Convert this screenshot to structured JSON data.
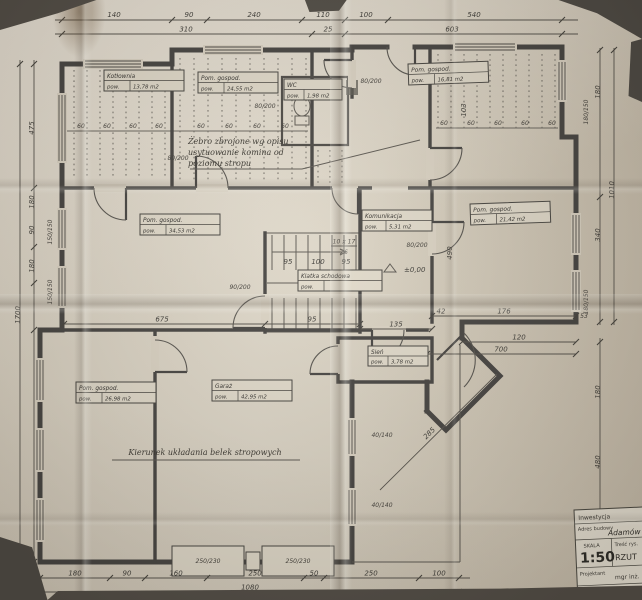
{
  "scene": {
    "background": "#55504a",
    "paper": "#dcd4c4",
    "ink": "#454340"
  },
  "rooms": [
    {
      "name": "Kotłownia",
      "pow": "pow.",
      "area": "13,78 m2"
    },
    {
      "name": "Pom. gospod.",
      "pow": "pow.",
      "area": "24,55 m2"
    },
    {
      "name": "WC",
      "pow": "pow.",
      "area": "1,98 m2"
    },
    {
      "name": "Pom. gospod.",
      "pow": "pow.",
      "area": "16,81 m2"
    },
    {
      "name": "Pom. gospod.",
      "pow": "pow.",
      "area": "34,53 m2"
    },
    {
      "name": "Komunikacja",
      "pow": "pow.",
      "area": "5,31 m2"
    },
    {
      "name": "Pom. gospod.",
      "pow": "pow.",
      "area": "21,42 m2"
    },
    {
      "name": "Klatka schodowa",
      "pow": "pow.",
      "area": ""
    },
    {
      "name": "Pom. gospod.",
      "pow": "pow.",
      "area": "26,98 m2"
    },
    {
      "name": "Garaż",
      "pow": "pow.",
      "area": "42,95 m2"
    },
    {
      "name": "Sień",
      "pow": "pow.",
      "area": "3,78 m2"
    }
  ],
  "annotations": {
    "rebar1": "Żebro zbrojone wg opisu",
    "rebar2": "usytuowanie komina od",
    "rebar3": "poziomu stropu",
    "beams": "Kierunek układania belek stropowych",
    "level": "±0,00",
    "stair_count": "10 x 17",
    "stair_tread": "26"
  },
  "dims": {
    "top1": [
      "140",
      "90",
      "240",
      "110",
      "100",
      "540"
    ],
    "top2": [
      "310",
      "25",
      "603"
    ],
    "left": {
      "total": "1700",
      "a": "475",
      "b": "180",
      "c": "90",
      "d": "180",
      "win": "150/150"
    },
    "right": {
      "a": "180",
      "b": "340",
      "outer": "1010",
      "c": "180",
      "d": "480",
      "win": "180/150",
      "e": "53",
      "f": "120",
      "g": "700",
      "h": "490",
      "v": "103"
    },
    "bottom": [
      "180",
      "90",
      "160",
      "250",
      "50",
      "250",
      "100"
    ],
    "bottom_total": "1080",
    "inner": {
      "a": "675",
      "b": "95",
      "c": "135",
      "d": "42",
      "e": "176",
      "f": "285",
      "g": "95",
      "h": "100",
      "spacing": "60"
    },
    "doors": {
      "d80": "80/200",
      "d90": "90/200",
      "win40140": "40/140",
      "gate": "250/230"
    }
  },
  "title_block": {
    "inwestycja": "Inwestycja",
    "addr_label": "Adres budowy",
    "addr_value": "Adamów",
    "scale_label": "SKALA",
    "scale_value": "1:50",
    "drawing_label": "Treść rys.",
    "drawing_value": "RZUT",
    "designer_label": "Projektant",
    "designer_value": "mgr inż."
  }
}
